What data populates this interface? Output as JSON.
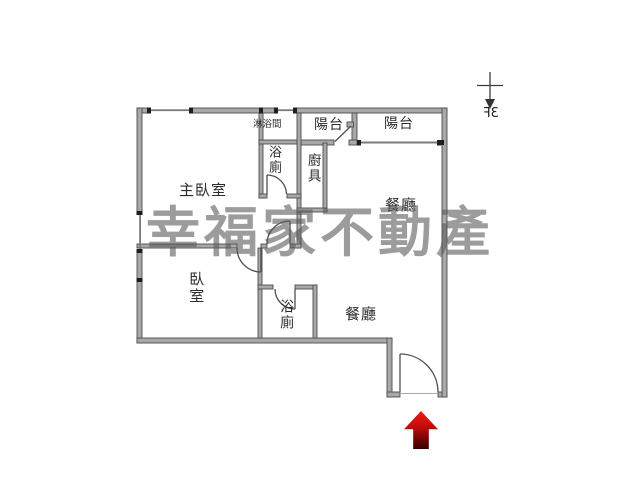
{
  "document": {
    "kind": "apartment floor plan",
    "background": "#ffffff"
  },
  "watermark": {
    "text": "幸福家不動產",
    "color": "#909090"
  },
  "orientation": {
    "floor_label": "3F",
    "mirrored": true,
    "arrow_direction": "down"
  },
  "rooms": {
    "shower": {
      "label": "淋浴間"
    },
    "bath_top": {
      "label": "浴廁"
    },
    "kitchen": {
      "label": "廚具"
    },
    "balcony_left": {
      "label": "陽台"
    },
    "balcony_right": {
      "label": "陽台"
    },
    "master_bedroom": {
      "label": "主臥室"
    },
    "dining_upper": {
      "label": "餐廳"
    },
    "bedroom": {
      "label": "臥室"
    },
    "bath_bottom": {
      "label": "浴廁"
    },
    "dining_lower": {
      "label": "餐廳"
    }
  },
  "entrance": {
    "symbol": "red arrow pointing up at main door"
  },
  "colors": {
    "wall_fill": "#a8a8a8",
    "wall_edge": "#4d4d4d",
    "thin_line": "#7a7a7a",
    "arrow_top": "#ec1b15",
    "arrow_bottom": "#330303"
  }
}
